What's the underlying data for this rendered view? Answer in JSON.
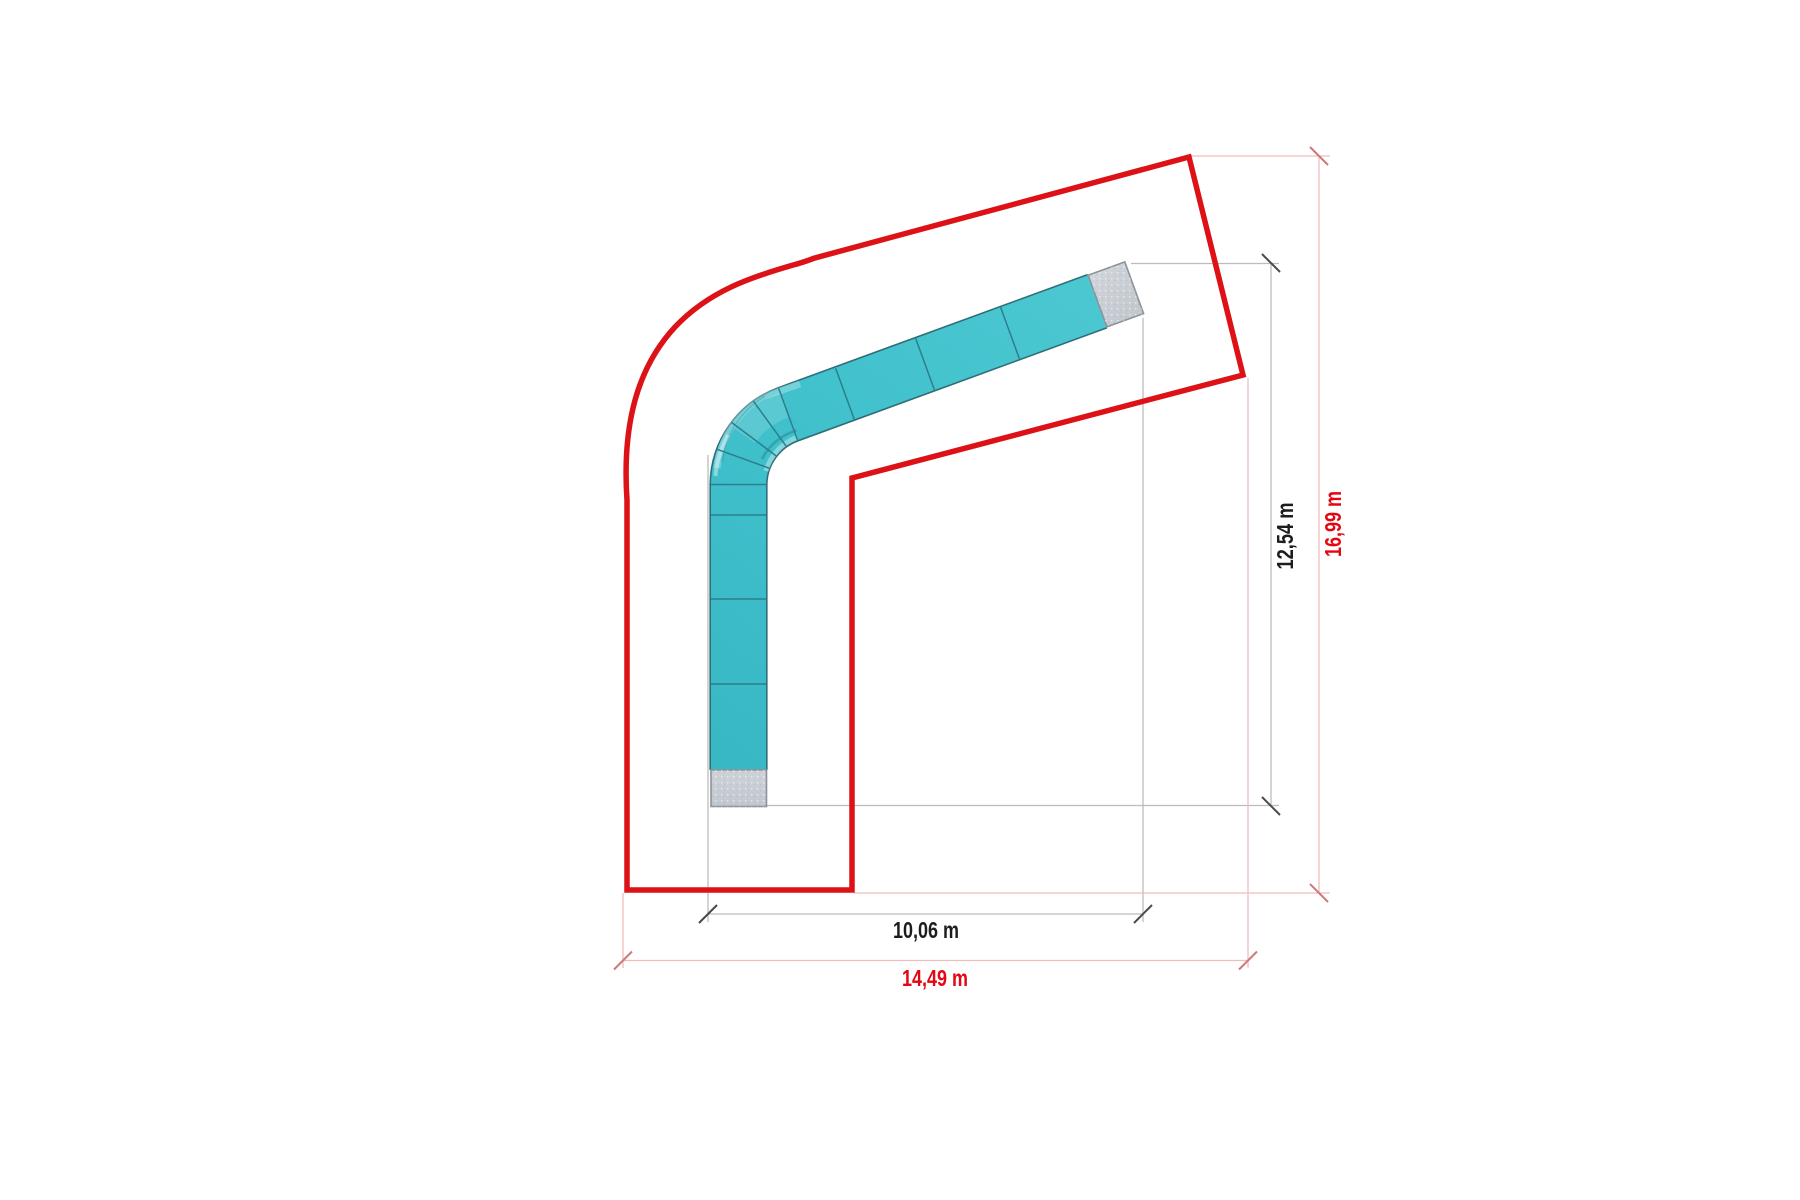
{
  "drawing": {
    "description_labels": {
      "inner_width": "10,06 m",
      "inner_height": "12,54 m",
      "outer_width": "14,49 m",
      "outer_height": "16,99 m"
    },
    "colors": {
      "background": "#ffffff",
      "site_boundary_red": "#dc1217",
      "red_dimension_text": "#e30613",
      "black_dimension_text": "#1d1d1d",
      "red_dimension_line": "#f0bcbc",
      "red_dimension_tick": "#cf7a7a",
      "gray_dimension_line": "#bcbcbc",
      "black_dimension_tick": "#4a4a4a",
      "flume_teal": "#3fc0cb",
      "flume_outline": "#2f6e78",
      "flume_divider": "#2e7e8c",
      "end_cap_gray": "#c9ced6",
      "end_cap_border": "#8d9399"
    }
  }
}
